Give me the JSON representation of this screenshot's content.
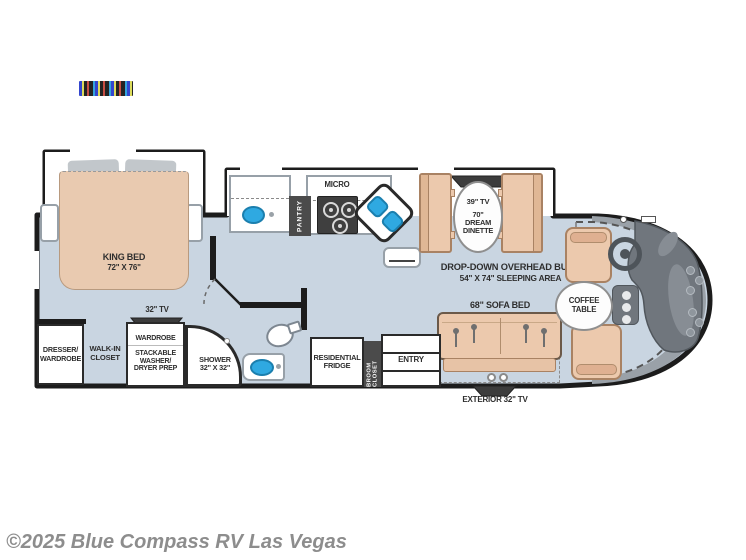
{
  "watermark": "©2025 Blue Compass RV Las Vegas",
  "colors": {
    "floor": "#c9d5e1",
    "wall": "#1c1c1c",
    "slide_interior": "#ffffff",
    "furniture_tan": "#ecc9ad",
    "bed_tan": "#e9cab0",
    "sink_blue": "#2fa9e1",
    "fixture_dark": "#454545",
    "front_cap_gray": "#9aa1a8",
    "dash_gray": "#70767d",
    "label_text": "#2e2e2e",
    "watermark_gray": "#8d8d8d"
  },
  "bedroom": {
    "bed_line1": "KING BED",
    "bed_line2": "72\" X 76\"",
    "tv": "32\" TV",
    "dresser_line1": "DRESSER/",
    "dresser_line2": "WARDROBE",
    "walkin_line1": "WALK-IN",
    "walkin_line2": "CLOSET",
    "wardrobe": "WARDROBE",
    "washer_line1": "STACKABLE",
    "washer_line2": "WASHER/",
    "washer_line3": "DRYER PREP"
  },
  "bathroom": {
    "shower_line1": "SHOWER",
    "shower_line2": "32\" X 32\""
  },
  "kitchen": {
    "pantry": "PANTRY",
    "micro": "MICRO"
  },
  "dinette": {
    "tv": "39\" TV",
    "line1": "70\"",
    "line2": "DREAM",
    "line3": "DINETTE"
  },
  "living": {
    "bunk_line1": "DROP-DOWN OVERHEAD BUNK",
    "bunk_line2": "54\" X 74\" SLEEPING AREA",
    "sofa": "68\" SOFA BED",
    "coffee_line1": "COFFEE",
    "coffee_line2": "TABLE",
    "exterior_tv": "EXTERIOR 32\" TV"
  },
  "utility": {
    "fridge_line1": "RESIDENTIAL",
    "fridge_line2": "FRIDGE",
    "broom": "BROOM CLOSET",
    "entry": "ENTRY"
  }
}
